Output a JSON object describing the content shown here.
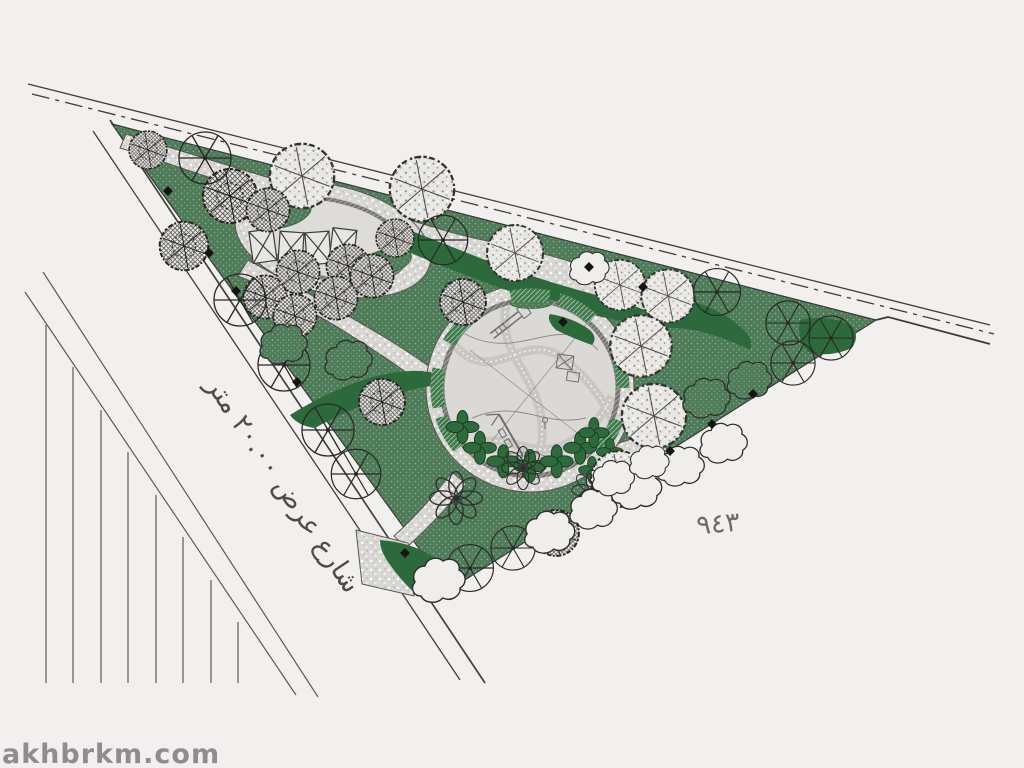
{
  "canvas": {
    "width": 1024,
    "height": 768,
    "background": "#f2f0ee"
  },
  "labels": {
    "street": {
      "text": "شارع عرض ٢٠.٠٠ متر",
      "translation_hint": "street-width-20m-label",
      "color": "#4e4c49",
      "rotation_deg": 56
    },
    "plot_number": {
      "text": "٩٤٣",
      "translation_hint": "plot-number-943",
      "color": "#6e6c69",
      "rotation_deg": -5
    },
    "watermark": {
      "text": "akhbrkm.com",
      "color": "#8e8c8c"
    }
  },
  "palette": {
    "background": "#f2f0ee",
    "lawn_green": "#4e7b58",
    "dark_green": "#2d6a3b",
    "path_gray": "#d9d7d4",
    "floor_gray": "#dbd9d6",
    "rim_gray": "#93918e",
    "line_dark": "#3b3937",
    "tree_line": "#26241f"
  },
  "features": [
    "triangular-park-site",
    "perimeter-street-edges",
    "dash-dot-boundary-line",
    "neighbor-plot-subdivision-lines",
    "central-circular-playground",
    "oval-pergola-plaza",
    "lawn-areas",
    "stippled-walking-paths",
    "tree-plantings",
    "shrub-clouds",
    "bench-planters",
    "light-post-markers"
  ]
}
